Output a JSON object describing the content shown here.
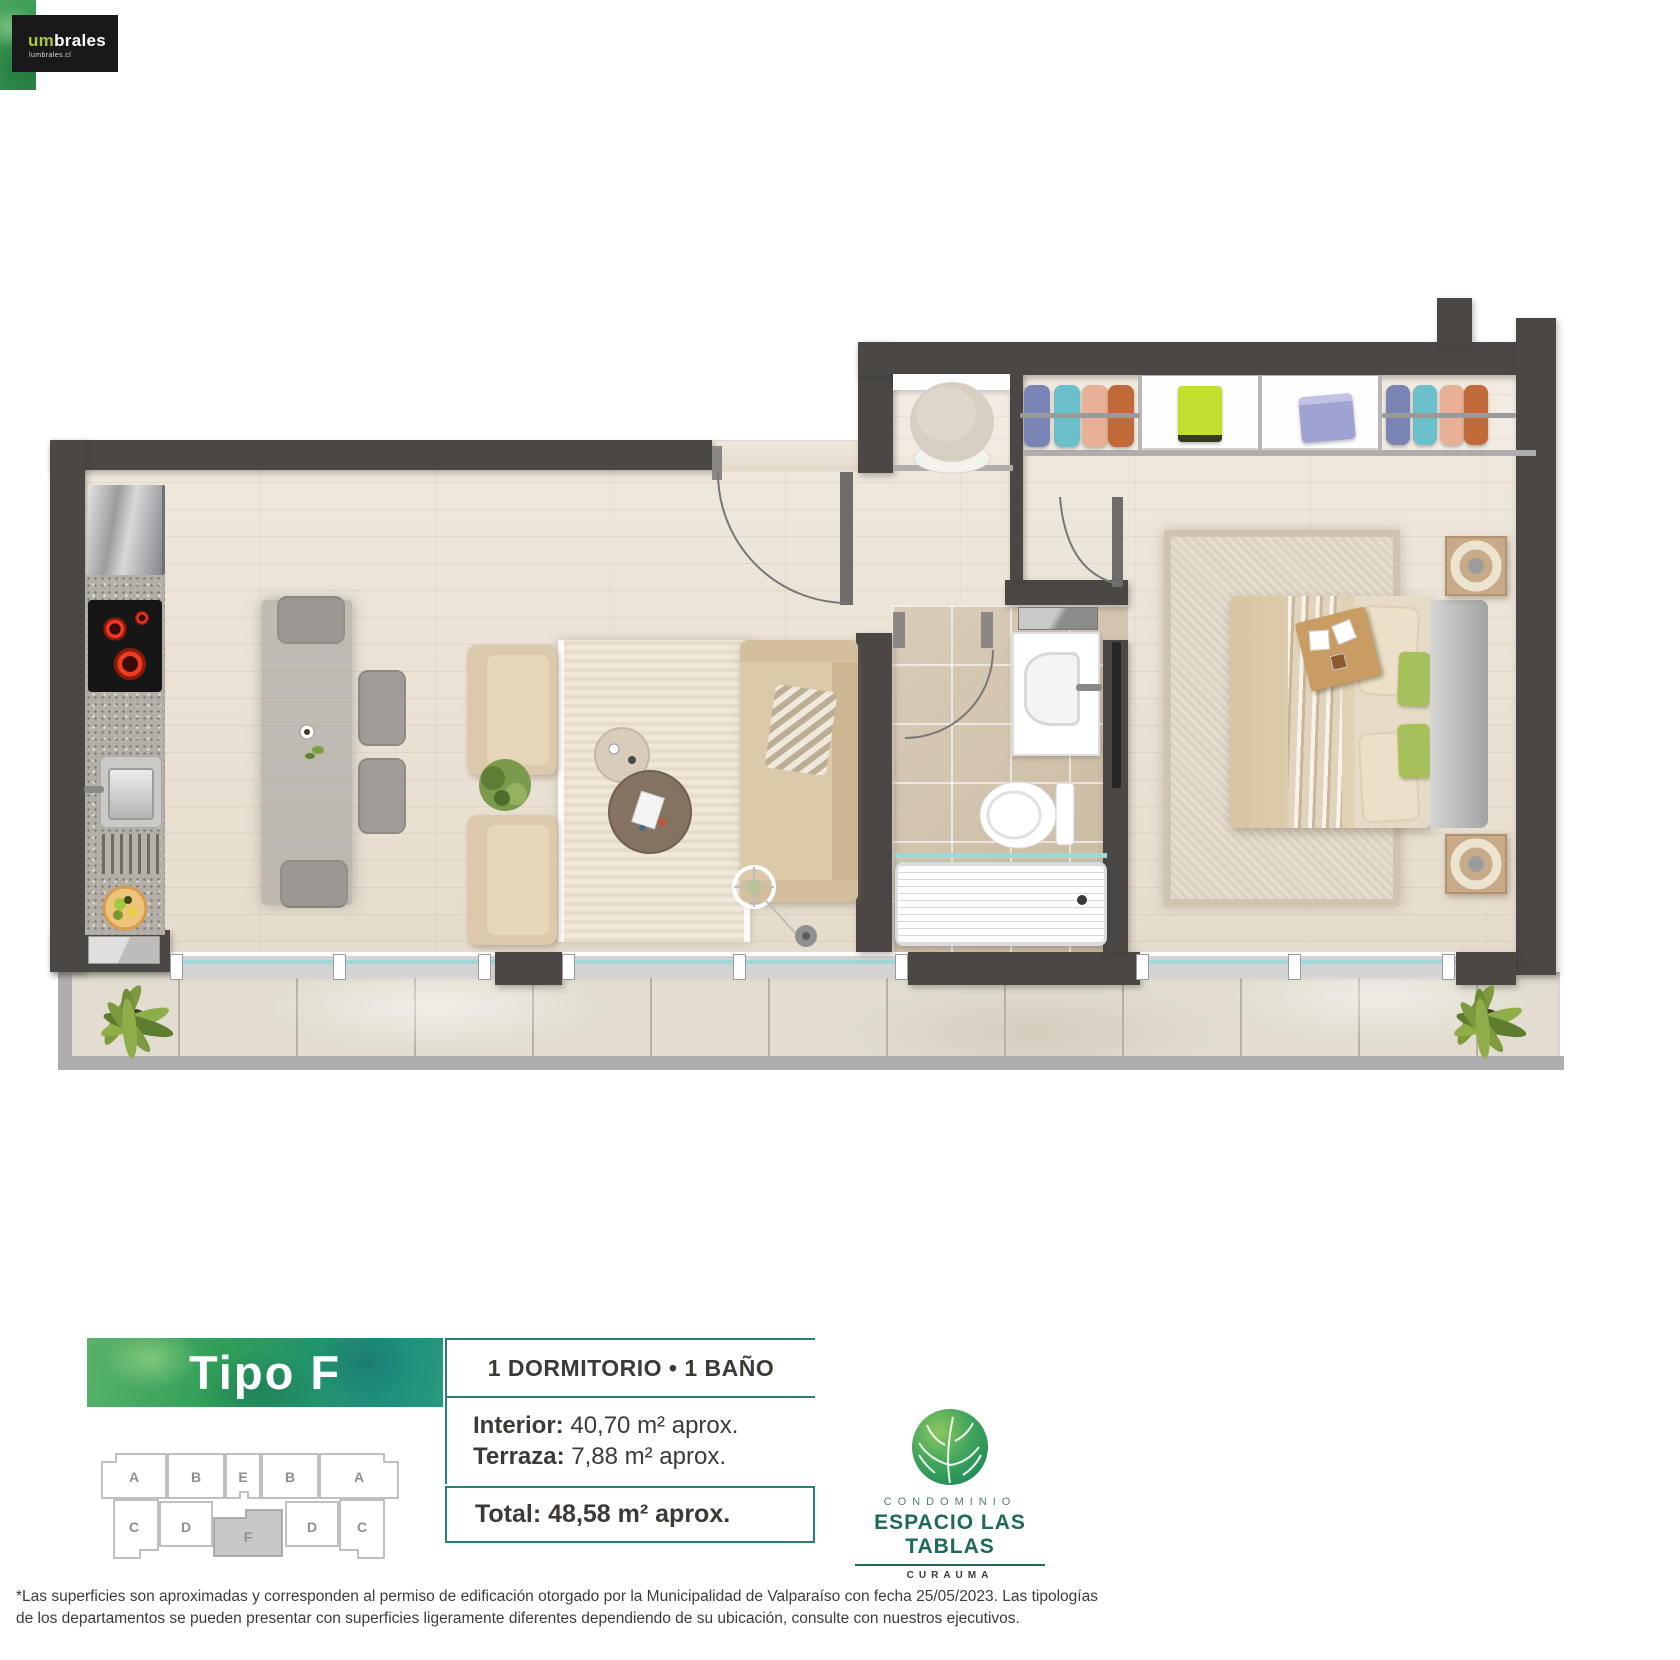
{
  "brand": {
    "um": "um",
    "brales": "brales",
    "domain": "lumbrales.cl"
  },
  "unit": {
    "type": "Tipo F",
    "config": "1 DORMITORIO • 1 BAÑO",
    "interior_label": "Interior:",
    "interior_value": " 40,70 m² aprox.",
    "terraza_label": "Terraza:",
    "terraza_value": " 7,88 m² aprox.",
    "total_label": "Total:",
    "total_value": " 48,58 m² aprox."
  },
  "building": {
    "top": [
      "A",
      "B",
      "E",
      "B",
      "A"
    ],
    "bottom": [
      "C",
      "D",
      "D",
      "C"
    ],
    "highlight": "F"
  },
  "project": {
    "category": "CONDOMINIO",
    "name": "ESPACIO LAS TABLAS",
    "location": "CURAUMA"
  },
  "disclaimer": {
    "line1": "*Las superficies son aproximadas y corresponden al permiso de edificación otorgado por la Municipalidad de Valparaíso con fecha 25/05/2023. Las tipologías",
    "line2": "de los departamentos se pueden presentar con superficies ligeramente diferentes dependiendo de su ubicación, consulte con nuestros ejecutivos."
  },
  "colors": {
    "accent_teal": "#2b7e74",
    "brand_lime": "#a8c93a",
    "text_dark": "#3d3935",
    "wall": "#4a4745",
    "banner_green": "#2f9e58"
  }
}
